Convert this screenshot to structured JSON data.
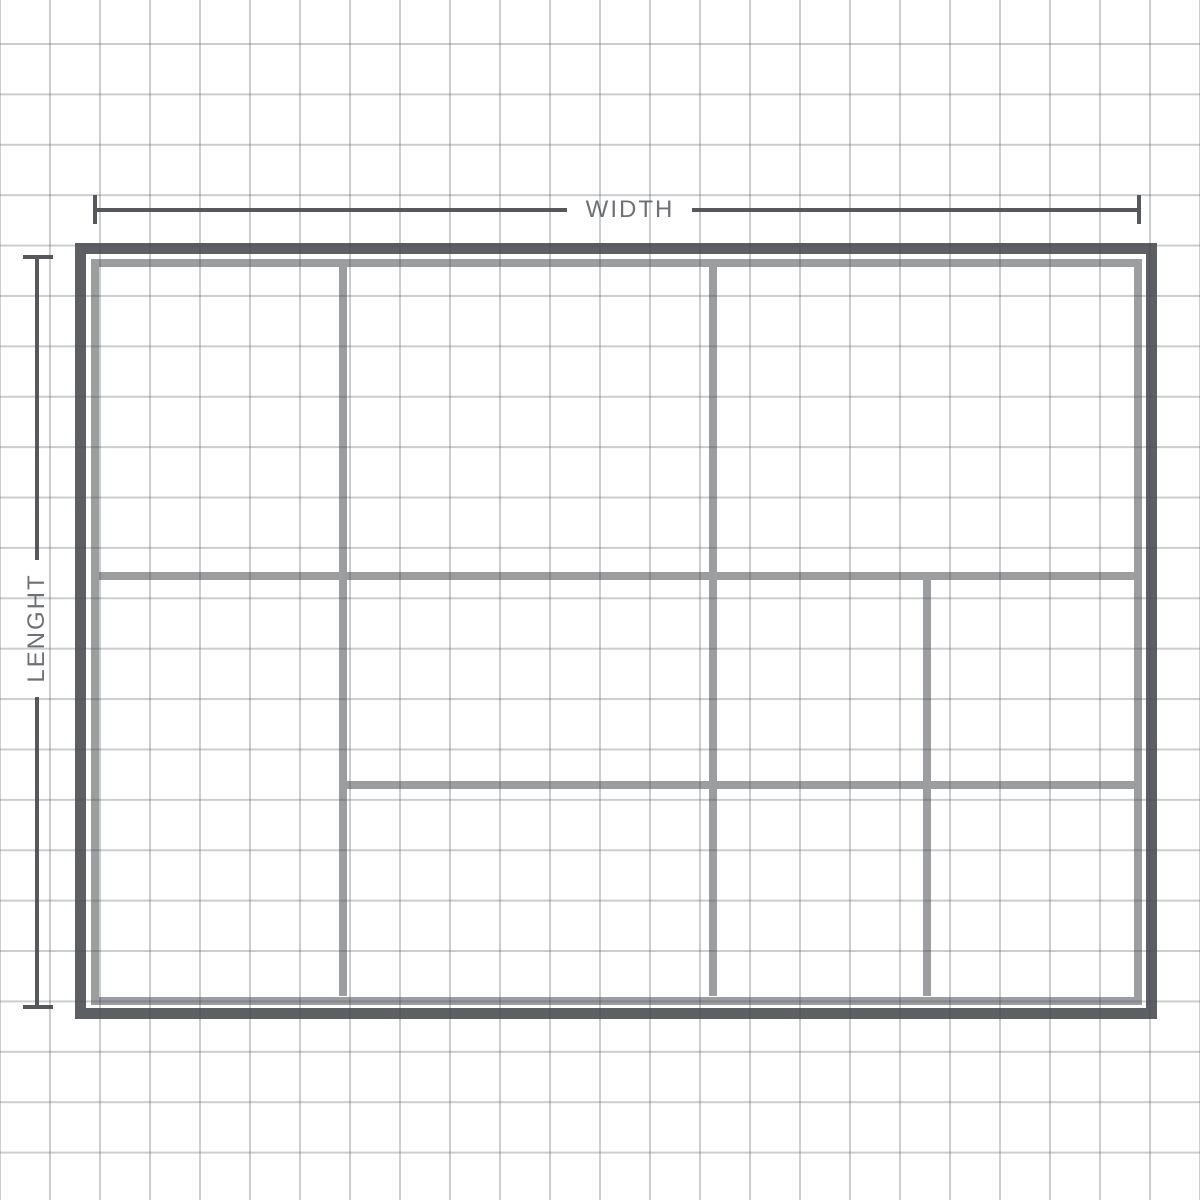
{
  "dimension_labels": {
    "width": "WIDTH",
    "length": "LENGHT"
  },
  "colors": {
    "background": "#ffffff",
    "grid_line": "#cdd0d2",
    "outer_border": "#5d5f63",
    "inner_border_and_dividers": "#9b9d9f",
    "dimension_line": "#57585b",
    "dimension_text": "#6e7073"
  }
}
